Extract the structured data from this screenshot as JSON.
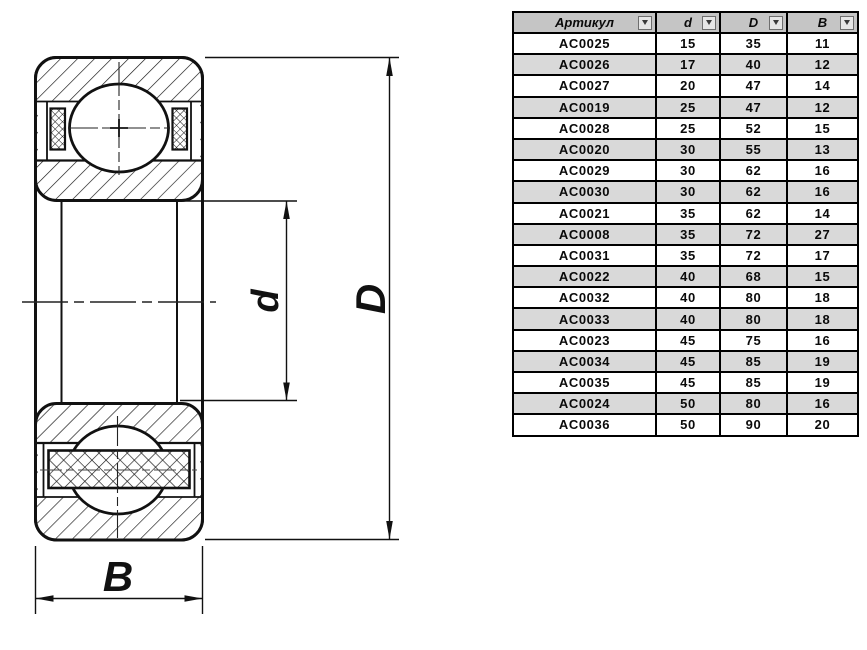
{
  "drawing": {
    "dimension_labels": {
      "width": "B",
      "bore_diameter": "d",
      "outer_diameter": "D"
    }
  },
  "table": {
    "columns": [
      {
        "label": "Артикул"
      },
      {
        "label": "d"
      },
      {
        "label": "D"
      },
      {
        "label": "B"
      }
    ],
    "rows": [
      [
        "AC0025",
        "15",
        "35",
        "11"
      ],
      [
        "AC0026",
        "17",
        "40",
        "12"
      ],
      [
        "AC0027",
        "20",
        "47",
        "14"
      ],
      [
        "AC0019",
        "25",
        "47",
        "12"
      ],
      [
        "AC0028",
        "25",
        "52",
        "15"
      ],
      [
        "AC0020",
        "30",
        "55",
        "13"
      ],
      [
        "AC0029",
        "30",
        "62",
        "16"
      ],
      [
        "AC0030",
        "30",
        "62",
        "16"
      ],
      [
        "AC0021",
        "35",
        "62",
        "14"
      ],
      [
        "AC0008",
        "35",
        "72",
        "27"
      ],
      [
        "AC0031",
        "35",
        "72",
        "17"
      ],
      [
        "AC0022",
        "40",
        "68",
        "15"
      ],
      [
        "AC0032",
        "40",
        "80",
        "18"
      ],
      [
        "AC0033",
        "40",
        "80",
        "18"
      ],
      [
        "AC0023",
        "45",
        "75",
        "16"
      ],
      [
        "AC0034",
        "45",
        "85",
        "19"
      ],
      [
        "AC0035",
        "45",
        "85",
        "19"
      ],
      [
        "AC0024",
        "50",
        "80",
        "16"
      ],
      [
        "AC0036",
        "50",
        "90",
        "20"
      ]
    ]
  },
  "colors": {
    "line": "#111111",
    "table_border": "#000000",
    "table_header_bg": "#c5c5c5",
    "table_row_alt_bg": "#d9d9d9"
  }
}
